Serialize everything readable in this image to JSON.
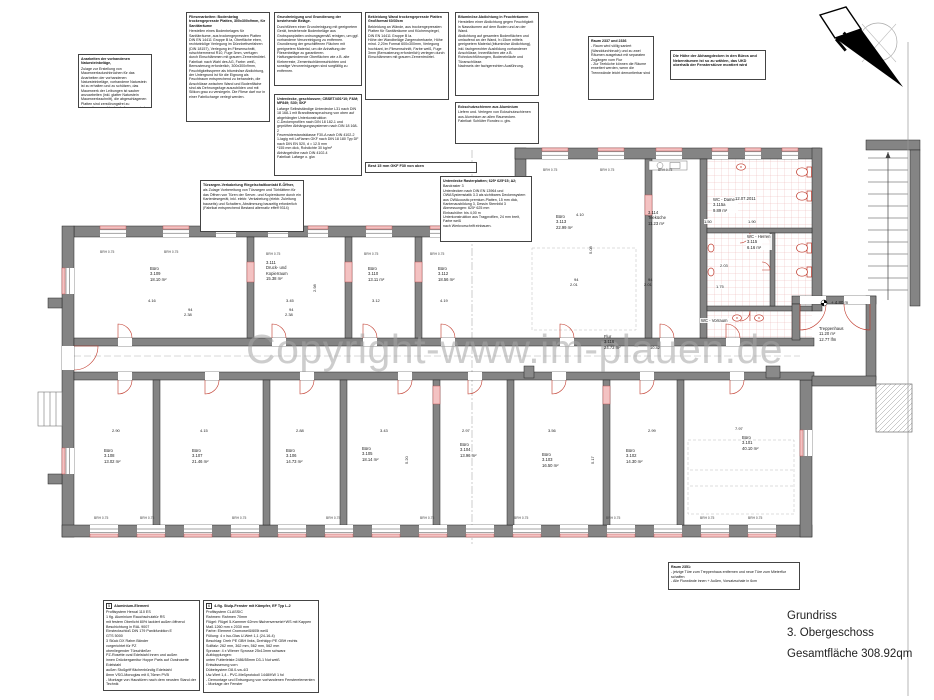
{
  "watermark": "Copyright-www.im-plauen.de",
  "north": {
    "label": "N"
  },
  "title_block": {
    "line1": "Grundriss",
    "line2": "3. Obergeschoss",
    "line3": "Gesamtfläche  308.92qm"
  },
  "colors": {
    "wall_gray": "#848484",
    "new_work_red": "#c0392b",
    "lintel_pink": "#f3c2c2",
    "tile_red": "#e5a3a3",
    "watermark_gray": "#a6a6a6"
  },
  "notes": [
    {
      "x": 78,
      "y": 54,
      "w": 74,
      "h": 54,
      "title": "Anarbeiten der vorhandenen Natursteinbeläge,",
      "body": "Zulage zur Erstellung von Mauerwerksdurchbrüchen für das Anarbeiten der vorhandenen Natursteinbeläge, vorhandene Naturstein ist zu erhalten und zu schützen, das Mauerwerk der Leibungen ist sauber anzuarbeiten (inkl. glatter Naturstein Mauerwerksschnitt), die abgeschlagenen Platten sind zerstörungsfrei zu demontieren und in den Leibungen wieder einzubauen."
    },
    {
      "x": 186,
      "y": 12,
      "w": 84,
      "h": 110,
      "title": "Fliesenarbeiten: Bodenbelag trockengepresste Platten, 300x300x9mm, für Sanitärräume",
      "body": "Herstellen eines Bodenbelages für Sanitärräume, aus trockengepressten Platten DIN EN 14411 Gruppe B Ia, Oberfläche eben, rechtwinklige Verlegung im Dünnbettverfahren (DIN 18157), Verlegung im Fliesenschnitt, rutschhemmend R10, Fuge 3mm, verfugen durch Einschlämmen mit grauem Zementmörtel.\nFabrikat: nach Wahl des AG, Farbe: weiß, Bemusterung erforderlich, 300x300x9mm, Feuchtigkeitssperre als bituminöse Abdichtung, der Untergrund ist für die Eignung als Feuchtraum entsprechend zu behandeln, die Anschlüsse zwischen Wand und Bodenfläche sind als Dehnungsfuge auszubilden und mit Silikon grau zu versiegeln. Die Fliese darf nur in einer Fabrikcharge verlegt werden."
    },
    {
      "x": 274,
      "y": 12,
      "w": 88,
      "h": 74,
      "title": "Grundreinigung und Grundierung der bestehende Beläge.",
      "body": "Durchführen einer Grundreinigung mit geeignetem Gerät, bestehende Bodenbeläge aus Grobspanplatten ordnungsgemäß reinigen, um ggf. vorhandene Verunreinigung zu entfernen.\nGrundierung der geschliffenen Flächen mit geeignetem Material, um die Anhaftung der Fliesenbeläge zu garantieren.\nHaftungsmindernde Oberflächen wie z.B. alte Kleberreste, Zementschlämmschichten und sonstige Verunreinigungen sind sorgfältig zu entfernen."
    },
    {
      "x": 274,
      "y": 94,
      "w": 88,
      "h": 82,
      "title": "Unterdecke, geschlossen; CBSET/401*10; F&M; MF849; S30; SKF",
      "body": "Lafarge Selbstständige Unterdecke L31 nach DIN 18 168-1 mit Brandbeanspruchung von oben auf abgehängter Unterkonstruktion\nC-Deckenprofilen nach DIN 18 182-1 und geprüften Abhängungssystemen nach DIN 18 168-2\nFeuerwiderstandsklasse F30-A nach DIN 4102-2\n1-lagig mit LaFlamm GKF nach DIN 18 180 Typ DF nach DIN EN 520, d = 12.5 mm\n*155 mm dick, Rohdichte 30 kg/m²\nAbhängehöhe nach DIN 4102-4\nFabrikat: Lafarge o. glw."
    },
    {
      "x": 365,
      "y": 12,
      "w": 84,
      "h": 88,
      "title": "Bekleidung Wand trockengepresste Platten Großformat 60/30cm",
      "body": "Bekleidung an Wände, aus trockengepressten Platten für Sanitärräume und Küchenspiegel, DIN EN 14411 Gruppe B Ia.\nHöhe der Wandbeläge Zargenoberkante, Höhe mind. 2,20m Format 600x300mm, Verlegung hochkant, im Fliesenschnitt, Farbe weiß, Fuge 3mm (Bemusterung erforderlich) verlegen durch Einschlämmen mit grauem Zementmörtel."
    },
    {
      "x": 455,
      "y": 12,
      "w": 84,
      "h": 84,
      "title": "Bituminöse Abdichtung in Feuchträumen",
      "body": "Herstellen einer Abdichtung gegen Feuchtigkeit in Nassräumen auf dem Boden und an der Wand.\nAbdichtung auf gesamten Bodenflächen und umlaufend an der Wand, h=15cm mittels geeignetem Material (bituminöse Abdichtung), inkl. fachgerechter Ausbildung vorhandener Anschlüsse, Innenflächen wie z.B. Rohrdurchführungen, Bodeneinläufe und Türanschlüsse.\nNachweis der fachgerechten Ausführung."
    },
    {
      "x": 455,
      "y": 102,
      "w": 84,
      "h": 42,
      "title": "Eckschutzschienen aus Aluminium",
      "body": "Liefern und. Verlegen von Eckschutzschienen aus Aluminium an allen Raumecken.\nFabrikat: Schlüter Rondec o. glw."
    },
    {
      "x": 588,
      "y": 36,
      "w": 66,
      "h": 64,
      "title": "Raum 2337 und 2336",
      "body": "- Raum wird völlig saniert (Wanddurchbruch) und zu zwei Räumen ausgebaut mit separaten Zugängen vom Flur\n- Zur Teeküche können die Räume erweitert werden, wenn die Trennwände leicht demontierbar sind"
    },
    {
      "x": 670,
      "y": 50,
      "w": 96,
      "h": 30,
      "cls": "boldnote",
      "title": "",
      "body": "Die Höhe der Abhangdecken in den Büros und Nebenräumen ist so zu wählen, das UKD oberhalb der Fensterstürze montiert wird"
    },
    {
      "x": 200,
      "y": 180,
      "w": 104,
      "h": 52,
      "title": "Türzargen-Verkabelung Riegelschaltkontakt E-Öffner,",
      "body": "als Zulage Vorbereitung von Türzargen und Türblättern für das Öffnen von Türen der Server- und Kopierräume durch ein Kartenlesegerät, inkl. elektr. Verkabelung (elektr. Zuleitung bauseits) und Schaltern, Abstimmung bauseitig erforderlich\n(Fabrikat entsprechend Bestand alternativ effeff 9314)"
    },
    {
      "x": 365,
      "y": 162,
      "w": 112,
      "h": 11,
      "cls": "strip",
      "title": "Best 15 mm GKF F30 von oben",
      "body": ""
    },
    {
      "x": 440,
      "y": 176,
      "w": 92,
      "h": 66,
      "title": "Unterdecke Rasterplatten; 625* 625*15; A2;",
      "body": "Bandraster 3\nUnterdecken nach DIN EN 13964 und OWASystemstatik 3.3 als sichtbares Deckensystem\naus OWAcoustic premium-Platten, 15 mm dick, Kantenausbildung 3, Dessin Sternbild 3\nAbmessungen: 625* 625 mm\nEinbauhöhe: bis 4,00 m\nUnterkonstruktion aus Tragprofilen, 24 mm breit, Farbe weiß\nnach Werkvorschrift einbauen."
    },
    {
      "x": 668,
      "y": 562,
      "w": 132,
      "h": 28,
      "title": "Raum 2351:",
      "body": "- jetzige Türe zum Treppenhaus entfernen und neue Türe zum Mieterflur schaffen\n- Alle Flurwände innen + Außen, Vorsatzschale in 6cm"
    },
    {
      "x": 103,
      "y": 600,
      "w": 97,
      "h": 91,
      "cls": "legend",
      "num": "5",
      "title": "Aluminium-Element",
      "body": "Profilsystem Heroal 110 ES\n1 flg. Aluminium Rauchschutztür RS\nmit festem Oberlicht 80% lackiert außen öffnend\nBeschichtung in RAL 9007\nEinsteckschloß DIN 179 Panikfunktion E\nGTS 5000\n3 Stück DX Rahm Bänder\nvorgerichtet für PZ\nobenliegender Türschließer\nPZ-Rosette oval Edelstahl innen und außen\ninnen Drückergarnitur Hoppe Paris auf Ovalrosette Edelstahl\naußen Stoßgriff flächenbündig Edelstahl\n8mm VSG-Monoglas mit 0,76mm PVB\n- Montage von Haustüren nach dem neusten Stand der Technik"
    },
    {
      "x": 203,
      "y": 600,
      "w": 116,
      "h": 93,
      "cls": "legend",
      "num": "6",
      "title": "4-flg. Stulp-Fenster mit Kämpfer, EF Typ L-2",
      "body": "Profilsystem CLASSIC\nRahmen: Rahmen 70mm\nFlügel: Flügel 5-Kammer 62mm flächenversetzt+WS mit Kappen\nMaß 1260 mm x 2030 mm\nFarbe: Element Cromoweiß/605t weiß\nFüllung: 4 x Iso-Glas U-Wert 1,1 (24-16-4)\nBeschlag: Dreh PE GBH links, Drehkipp PE GBH rechts\nSollfalz: 262 mm, 362 mm, 562 mm, 562 mm\nSprosse: 4 x Wiener Sprosse 25x13mm schwarz\nAufdopplungen:\nunten Futterleiste 2486/55mm D3-1 Nut weiß\nEntwässerung vorn\nDübelsystem D8.0-vw-4/3\nUw-Wert 1,4 - PVC-Meßprotokoll 1448/KW 1 fol\n- Demontage und Entsorgung von vorhandenen Fensterelementen\n- Montage der Fenster"
    }
  ],
  "rooms": [
    {
      "l1": "Büro",
      "l2": "3.109",
      "l3": "18.10 m²",
      "x": 150,
      "y": 266
    },
    {
      "l1": "3.111",
      "l2": "Druck- und",
      "l3": "Kopierraum",
      "l4": "15.38 m²",
      "x": 266,
      "y": 260
    },
    {
      "l1": "Büro",
      "l2": "3.110",
      "l3": "13.11 m²",
      "x": 368,
      "y": 266
    },
    {
      "l1": "Büro",
      "l2": "3.112",
      "l3": "18.56 m²",
      "x": 438,
      "y": 266
    },
    {
      "l1": "Büro",
      "l2": "3.113",
      "l3": "22.99 m²",
      "x": 556,
      "y": 214
    },
    {
      "l1": "3.114",
      "l2": "Teeküche",
      "l3": "11.23 m²",
      "x": 648,
      "y": 210
    },
    {
      "l1": "WC - Damen",
      "l2": "3.115a",
      "l3": "9.89 m²",
      "x": 712,
      "y": 197,
      "cls": "bg"
    },
    {
      "l1": "WC - Herren",
      "l2": "3.115",
      "l3": "6.16 m²",
      "x": 746,
      "y": 234,
      "cls": "bg"
    },
    {
      "l1": "WC - Vorraum",
      "x": 700,
      "y": 318,
      "cls": "bg"
    },
    {
      "l1": "Flur",
      "l2": "3.116",
      "l3": "24.73 m²",
      "x": 604,
      "y": 334
    },
    {
      "l1": "Treppenhaus",
      "l2": "11.20 m²",
      "l3": "12.77 lfm",
      "x": 818,
      "y": 326,
      "cls": "bg"
    },
    {
      "l1": "Büro",
      "l2": "3.108",
      "l3": "13.02 m²",
      "x": 104,
      "y": 448
    },
    {
      "l1": "Büro",
      "l2": "3.107",
      "l3": "21.46 m²",
      "x": 192,
      "y": 448
    },
    {
      "l1": "Büro",
      "l2": "3.106",
      "l3": "14.73 m²",
      "x": 286,
      "y": 448
    },
    {
      "l1": "Büro",
      "l2": "3.105",
      "l3": "18.14 m²",
      "x": 362,
      "y": 446
    },
    {
      "l1": "Büro",
      "l2": "3.104",
      "l3": "13.96 m²",
      "x": 460,
      "y": 442
    },
    {
      "l1": "Büro",
      "l2": "3.103",
      "l3": "16.50 m²",
      "x": 542,
      "y": 452
    },
    {
      "l1": "Büro",
      "l2": "3.102",
      "l3": "14.30 m²",
      "x": 626,
      "y": 448
    },
    {
      "l1": "Büro",
      "l2": "3.101",
      "l3": "40.10 m²",
      "x": 742,
      "y": 435
    }
  ],
  "dims": [
    {
      "t": "4.16",
      "x": 148,
      "y": 298
    },
    {
      "t": "3.45",
      "x": 286,
      "y": 298
    },
    {
      "t": "3.12",
      "x": 372,
      "y": 298
    },
    {
      "t": "4.19",
      "x": 440,
      "y": 298
    },
    {
      "t": "94",
      "x": 188,
      "y": 307
    },
    {
      "t": "2.38",
      "x": 184,
      "y": 312
    },
    {
      "t": "94",
      "x": 289,
      "y": 307
    },
    {
      "t": "2.38",
      "x": 285,
      "y": 312
    },
    {
      "t": "2.98",
      "x": 312,
      "y": 292,
      "cls": "rot"
    },
    {
      "t": "2.90",
      "x": 112,
      "y": 428
    },
    {
      "t": "4.15",
      "x": 200,
      "y": 428
    },
    {
      "t": "2.88",
      "x": 296,
      "y": 428
    },
    {
      "t": "3.43",
      "x": 380,
      "y": 428
    },
    {
      "t": "2.97",
      "x": 462,
      "y": 428
    },
    {
      "t": "3.56",
      "x": 548,
      "y": 428
    },
    {
      "t": "2.99",
      "x": 648,
      "y": 428
    },
    {
      "t": "7.97",
      "x": 735,
      "y": 426
    },
    {
      "t": "5.20",
      "x": 404,
      "y": 464,
      "cls": "rot"
    },
    {
      "t": "5.17",
      "x": 590,
      "y": 464,
      "cls": "rot"
    },
    {
      "t": "5.08",
      "x": 588,
      "y": 254,
      "cls": "rot"
    },
    {
      "t": "4.10",
      "x": 576,
      "y": 212
    },
    {
      "t": "1.50",
      "x": 704,
      "y": 219,
      "cls": "bg"
    },
    {
      "t": "1.90",
      "x": 748,
      "y": 219,
      "cls": "bg"
    },
    {
      "t": "2.03",
      "x": 720,
      "y": 263,
      "cls": "bg"
    },
    {
      "t": "1.75",
      "x": 716,
      "y": 284,
      "cls": "bg"
    },
    {
      "t": "10.42",
      "x": 650,
      "y": 345
    },
    {
      "t": "94",
      "x": 574,
      "y": 277
    },
    {
      "t": "2.01",
      "x": 570,
      "y": 282
    },
    {
      "t": "94",
      "x": 648,
      "y": 277
    },
    {
      "t": "2.01",
      "x": 644,
      "y": 282
    },
    {
      "t": "12.07.2011",
      "x": 735,
      "y": 196,
      "cls": "date bg"
    },
    {
      "t": "+ 4.80 m",
      "x": 831,
      "y": 300,
      "cls": "level"
    },
    {
      "t": "BRH 0.75",
      "x": 100,
      "y": 250,
      "cls": "brh"
    },
    {
      "t": "BRH 0.75",
      "x": 164,
      "y": 250,
      "cls": "brh"
    },
    {
      "t": "BRH 0.75",
      "x": 266,
      "y": 252,
      "cls": "brh"
    },
    {
      "t": "BRH 0.75",
      "x": 364,
      "y": 252,
      "cls": "brh"
    },
    {
      "t": "BRH 0.75",
      "x": 430,
      "y": 252,
      "cls": "brh"
    },
    {
      "t": "BRH 0.75",
      "x": 543,
      "y": 168,
      "cls": "brh"
    },
    {
      "t": "BRH 0.75",
      "x": 600,
      "y": 168,
      "cls": "brh"
    },
    {
      "t": "BRH 0.75",
      "x": 658,
      "y": 168,
      "cls": "brh"
    },
    {
      "t": "BRH 0.75",
      "x": 94,
      "y": 516,
      "cls": "brh"
    },
    {
      "t": "BRH 0.75",
      "x": 140,
      "y": 516,
      "cls": "brh"
    },
    {
      "t": "BRH 0.75",
      "x": 232,
      "y": 516,
      "cls": "brh"
    },
    {
      "t": "BRH 0.75",
      "x": 326,
      "y": 516,
      "cls": "brh"
    },
    {
      "t": "BRH 0.75",
      "x": 420,
      "y": 516,
      "cls": "brh"
    },
    {
      "t": "BRH 0.75",
      "x": 514,
      "y": 516,
      "cls": "brh"
    },
    {
      "t": "BRH 0.75",
      "x": 606,
      "y": 516,
      "cls": "brh"
    },
    {
      "t": "BRH 0.75",
      "x": 700,
      "y": 516,
      "cls": "brh"
    },
    {
      "t": "BRH 0.75",
      "x": 748,
      "y": 516,
      "cls": "brh"
    }
  ]
}
